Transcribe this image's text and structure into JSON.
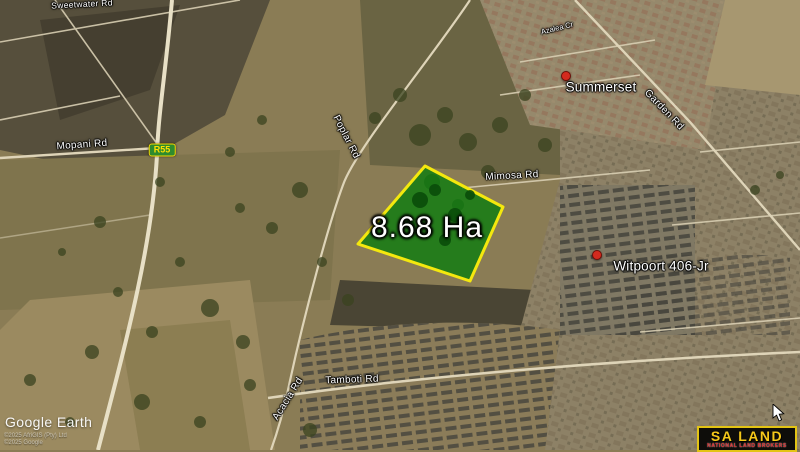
{
  "map": {
    "area_overlay": {
      "label": "8.68 Ha"
    },
    "route_shield": {
      "label": "R55"
    },
    "road_labels": [
      {
        "id": "sweetwater",
        "text": "Sweetwater Rd"
      },
      {
        "id": "mopani",
        "text": "Mopani Rd"
      },
      {
        "id": "poplar",
        "text": "Poplar Rd"
      },
      {
        "id": "mimosa",
        "text": "Mimosa Rd"
      },
      {
        "id": "garden",
        "text": "Garden Rd"
      },
      {
        "id": "azalea",
        "text": "Azalea Cr"
      },
      {
        "id": "acacia",
        "text": "Acacia Rd"
      },
      {
        "id": "tamboti",
        "text": "Tamboti Rd"
      }
    ],
    "place_labels": [
      {
        "id": "summerset",
        "text": "Summerset"
      },
      {
        "id": "witpoort",
        "text": "Witpoort 406-Jr"
      }
    ]
  },
  "watermark": {
    "brand": "Google Earth",
    "copyright_line1": "©2025 AfriGIS (Pty) Ltd",
    "copyright_line2": "©2025 Google"
  },
  "broker_logo": {
    "title": "SA LAND",
    "subtitle": "NATIONAL LAND BROKERS"
  },
  "colors": {
    "parcel_fill": "#0f7d10",
    "parcel_stroke": "#f4e80e",
    "shield_green": "#2e8b2e",
    "shield_text": "#ffe000",
    "logo_yellow": "#f5c81a",
    "logo_red": "#d42020"
  }
}
